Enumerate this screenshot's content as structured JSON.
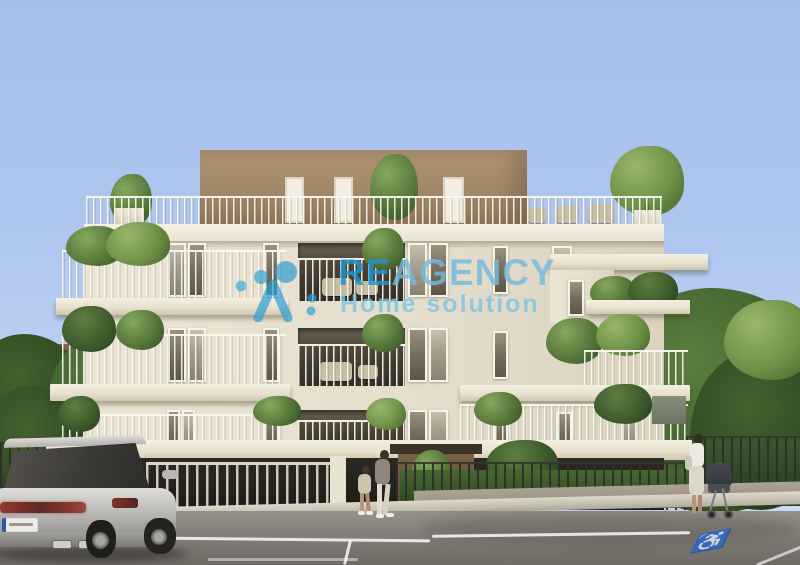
{
  "image": {
    "type": "architectural-rendering",
    "subject": "Modern four-storey cream apartment residence with brown penthouse level, roof terrace, planted balconies, gated ground-floor parking, street parking lot, a silver SUV, two pedestrians and a woman with a stroller"
  },
  "watermark": {
    "brand_prefix": "RE",
    "brand_suffix": "AGENCY",
    "tagline": "Home solution",
    "logo": "dotted-person-monogram",
    "brand_prefix_color": "#1f94cf",
    "brand_suffix_color": "#74bbde",
    "tagline_color": "#79c4e4"
  },
  "street": {
    "accessible_symbol": "♿",
    "marking_color": "#ffffff"
  },
  "palette": {
    "sky": "#aec6ef",
    "facade": "#e6decd",
    "parapet": "#f6f1e4",
    "penthouse_brown": "#a18767",
    "foliage_green": "#4c6b30",
    "ground_floor_dark": "#262320",
    "asphalt": "#85817a",
    "car_silver": "#b8b6b2",
    "hedge_green": "#3a5530"
  },
  "objects": [
    "apartment-building",
    "penthouse-level",
    "roof-terrace",
    "roof-terrace-tree",
    "balcony",
    "balcony-railing",
    "balcony-planting",
    "recessed-loggia",
    "ground-floor-fence",
    "hedge",
    "entrance-canopy",
    "parking-lot",
    "parking-space-markings",
    "accessible-parking-marking",
    "parked-suv",
    "pedestrian-pair",
    "woman-with-stroller",
    "background-house",
    "background-trees",
    "sidewalk-curb"
  ]
}
